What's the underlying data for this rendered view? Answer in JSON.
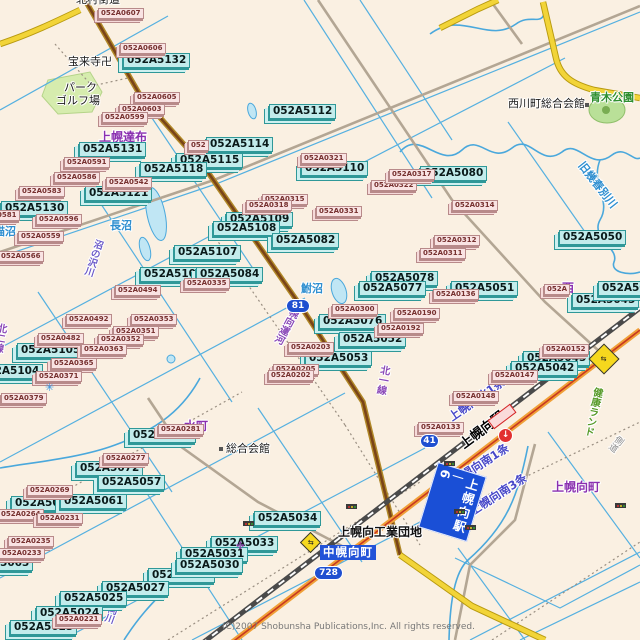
{
  "map": {
    "copyright": "(C)2007 Shobunsha Publications,Inc. All rights reserved.",
    "colors": {
      "background": "#faf0e2",
      "water": "#55b0e0",
      "lake_fill": "#c0e6f4",
      "cyan_label_bg": "#c2ecec",
      "pink_label_bg": "#f9e3e3",
      "national_road": "#f0a038",
      "pref_road_yellow": "#f2d438",
      "road_81_brown": "#7a4418",
      "railway": "#4a4a4a",
      "district_purple": "#8a2fb0",
      "badge_blue": "#1f4fd0",
      "banner_blue": "#2353d8",
      "park_green": "#d6ecae"
    },
    "station_banner": {
      "text": "上幌向駅",
      "number": "6"
    },
    "town_banner": {
      "text": "中幌向町"
    },
    "route_badges": [
      {
        "text": "81",
        "x": 286,
        "y": 299,
        "w": 22
      },
      {
        "text": "728",
        "x": 314,
        "y": 566,
        "w": 27
      },
      {
        "text": "41",
        "x": 420,
        "y": 434,
        "w": 17
      }
    ],
    "area_labels": [
      {
        "text": "北村街道",
        "x": 76,
        "y": -6,
        "kind": "black"
      },
      {
        "text": "宝来寺卍",
        "x": 68,
        "y": 56,
        "kind": "black"
      },
      {
        "text": "パーク",
        "x": 64,
        "y": 82,
        "kind": "black"
      },
      {
        "text": "ゴルフ場",
        "x": 56,
        "y": 95,
        "kind": "black"
      },
      {
        "text": "西川町総合会館",
        "x": 508,
        "y": 98,
        "kind": "black"
      },
      {
        "text": "総合会館",
        "x": 226,
        "y": 443,
        "kind": "black"
      },
      {
        "text": "上幌向工業団地",
        "x": 338,
        "y": 526,
        "kind": "blackbold"
      },
      {
        "text": "青木公園",
        "x": 590,
        "y": 92,
        "kind": "green"
      },
      {
        "text": "上幌達布",
        "x": 99,
        "y": 131,
        "kind": "purple"
      },
      {
        "text": "水町",
        "x": 184,
        "y": 420,
        "kind": "purple"
      },
      {
        "text": "上幌向町",
        "x": 552,
        "y": 481,
        "kind": "purple"
      },
      {
        "text": "西",
        "x": 562,
        "y": 282,
        "kind": "purple"
      },
      {
        "text": "長沼",
        "x": 110,
        "y": 220,
        "kind": "blue"
      },
      {
        "text": "鮒沼",
        "x": 301,
        "y": 283,
        "kind": "blue"
      },
      {
        "text": "猫沼",
        "x": -6,
        "y": 226,
        "kind": "blue"
      },
      {
        "text": "旧幾春別川",
        "x": 585,
        "y": 160,
        "kind": "blue",
        "rot": 52
      },
      {
        "text": "上幌向駅",
        "x": 458,
        "y": 441,
        "kind": "stationblack",
        "rot": -37
      },
      {
        "text": "上幌向北1条",
        "x": 447,
        "y": 414,
        "kind": "bluestreet",
        "rot": -35
      },
      {
        "text": "上幌向南1条",
        "x": 450,
        "y": 478,
        "kind": "bluestreet",
        "rot": -33
      },
      {
        "text": "上幌向南3条",
        "x": 468,
        "y": 508,
        "kind": "bluestreet",
        "rot": -33
      },
      {
        "text": "幌向運河",
        "x": 290,
        "y": 305,
        "kind": "rural",
        "vert": true,
        "rot": 28
      },
      {
        "text": "北一線",
        "x": 379,
        "y": 364,
        "kind": "rural",
        "vert": true,
        "rot": 10
      },
      {
        "text": "北二線",
        "x": -4,
        "y": 322,
        "kind": "rural",
        "vert": true,
        "rot": 10
      },
      {
        "text": "沼の沢川",
        "x": 94,
        "y": 238,
        "kind": "stream",
        "vert": true,
        "rot": 18
      },
      {
        "text": "幌向川",
        "x": 112,
        "y": 594,
        "kind": "stream",
        "vert": true,
        "rot": 20
      },
      {
        "text": "健康ランド",
        "x": 592,
        "y": 386,
        "kind": "greenvert",
        "vert": true,
        "rot": 12
      },
      {
        "text": "側道",
        "x": 617,
        "y": 433,
        "kind": "gray",
        "vert": true,
        "rot": 38
      }
    ],
    "parcel_labels_cyan": [
      {
        "text": "052A5132",
        "x": 123,
        "y": 53
      },
      {
        "text": "052A5112",
        "x": 269,
        "y": 104
      },
      {
        "text": "052A5114",
        "x": 206,
        "y": 137
      },
      {
        "text": "052A5131",
        "x": 79,
        "y": 142
      },
      {
        "text": "052A5115",
        "x": 176,
        "y": 153
      },
      {
        "text": "052A5118",
        "x": 140,
        "y": 162
      },
      {
        "text": "052A5121",
        "x": 85,
        "y": 186
      },
      {
        "text": "052A5130",
        "x": 1,
        "y": 201
      },
      {
        "text": "052A5110",
        "x": 301,
        "y": 161
      },
      {
        "text": "052A5109",
        "x": 226,
        "y": 212
      },
      {
        "text": "052A5108",
        "x": 213,
        "y": 221
      },
      {
        "text": "052A5082",
        "x": 272,
        "y": 233
      },
      {
        "text": "052A5080",
        "x": 420,
        "y": 166
      },
      {
        "text": "052A5107",
        "x": 174,
        "y": 245
      },
      {
        "text": "052A5106",
        "x": 140,
        "y": 267
      },
      {
        "text": "052A5084",
        "x": 196,
        "y": 267
      },
      {
        "text": "052A5105",
        "x": 17,
        "y": 343
      },
      {
        "text": "052A5104",
        "x": -24,
        "y": 364
      },
      {
        "text": "052A5078",
        "x": 371,
        "y": 271
      },
      {
        "text": "052A5077",
        "x": 359,
        "y": 281
      },
      {
        "text": "052A5076",
        "x": 319,
        "y": 314
      },
      {
        "text": "052A5052",
        "x": 339,
        "y": 332
      },
      {
        "text": "052A5053",
        "x": 305,
        "y": 351
      },
      {
        "text": "052A5051",
        "x": 451,
        "y": 281
      },
      {
        "text": "052A5050",
        "x": 559,
        "y": 230
      },
      {
        "text": "052A5045",
        "x": 572,
        "y": 293
      },
      {
        "text": "052A5046",
        "x": 598,
        "y": 281
      },
      {
        "text": "052A5043",
        "x": 523,
        "y": 351
      },
      {
        "text": "052A5042",
        "x": 511,
        "y": 361
      },
      {
        "text": "052A5074",
        "x": 129,
        "y": 428
      },
      {
        "text": "052A5072",
        "x": 76,
        "y": 461
      },
      {
        "text": "052A5057",
        "x": 98,
        "y": 475
      },
      {
        "text": "052A5069",
        "x": 11,
        "y": 496
      },
      {
        "text": "052A5061",
        "x": 60,
        "y": 494
      },
      {
        "text": "052A5063",
        "x": -34,
        "y": 556
      },
      {
        "text": "052A5028",
        "x": 148,
        "y": 568
      },
      {
        "text": "052A5027",
        "x": 102,
        "y": 581
      },
      {
        "text": "052A5025",
        "x": 60,
        "y": 591
      },
      {
        "text": "052A5024",
        "x": 36,
        "y": 606
      },
      {
        "text": "052A5023",
        "x": 10,
        "y": 620
      },
      {
        "text": "052A5034",
        "x": 254,
        "y": 511
      },
      {
        "text": "052A5033",
        "x": 211,
        "y": 536
      },
      {
        "text": "052A5031",
        "x": 181,
        "y": 547
      },
      {
        "text": "052A5030",
        "x": 176,
        "y": 558
      }
    ],
    "parcel_labels_pink": [
      {
        "text": "052A0607",
        "x": 98,
        "y": 8
      },
      {
        "text": "052A0606",
        "x": 120,
        "y": 43
      },
      {
        "text": "052A0605",
        "x": 134,
        "y": 92
      },
      {
        "text": "052A0603",
        "x": 119,
        "y": 104
      },
      {
        "text": "052A0599",
        "x": 102,
        "y": 112
      },
      {
        "text": "052A0591",
        "x": 64,
        "y": 157
      },
      {
        "text": "052A0586",
        "x": 54,
        "y": 172
      },
      {
        "text": "052A0583",
        "x": 19,
        "y": 186
      },
      {
        "text": "052A0581",
        "x": -26,
        "y": 210
      },
      {
        "text": "052A0596",
        "x": 36,
        "y": 214
      },
      {
        "text": "052A0559",
        "x": 18,
        "y": 231
      },
      {
        "text": "052A0566",
        "x": -2,
        "y": 251
      },
      {
        "text": "052A0542",
        "x": 106,
        "y": 177
      },
      {
        "text": "052A0321",
        "x": 301,
        "y": 153
      },
      {
        "text": "052A0322",
        "x": 371,
        "y": 180
      },
      {
        "text": "052A0317",
        "x": 389,
        "y": 169
      },
      {
        "text": "052A0315",
        "x": 262,
        "y": 194
      },
      {
        "text": "052A0318",
        "x": 246,
        "y": 200
      },
      {
        "text": "052A0331",
        "x": 316,
        "y": 206
      },
      {
        "text": "052A0314",
        "x": 452,
        "y": 200
      },
      {
        "text": "052A0312",
        "x": 434,
        "y": 235
      },
      {
        "text": "052A0311",
        "x": 420,
        "y": 248
      },
      {
        "text": "052A0335",
        "x": 184,
        "y": 278
      },
      {
        "text": "052A0494",
        "x": 115,
        "y": 285
      },
      {
        "text": "052A0492",
        "x": 66,
        "y": 314
      },
      {
        "text": "052A0482",
        "x": 38,
        "y": 333
      },
      {
        "text": "052A0353",
        "x": 131,
        "y": 314
      },
      {
        "text": "052A0351",
        "x": 113,
        "y": 326
      },
      {
        "text": "052A0352",
        "x": 98,
        "y": 334
      },
      {
        "text": "052A0363",
        "x": 81,
        "y": 344
      },
      {
        "text": "052A0365",
        "x": 51,
        "y": 358
      },
      {
        "text": "052A0371",
        "x": 36,
        "y": 371
      },
      {
        "text": "052A0379",
        "x": 1,
        "y": 393
      },
      {
        "text": "052A0300",
        "x": 332,
        "y": 304
      },
      {
        "text": "052A0190",
        "x": 394,
        "y": 308
      },
      {
        "text": "052A0192",
        "x": 378,
        "y": 323
      },
      {
        "text": "052A0203",
        "x": 288,
        "y": 342
      },
      {
        "text": "052A0205",
        "x": 273,
        "y": 364
      },
      {
        "text": "052A0202",
        "x": 268,
        "y": 370
      },
      {
        "text": "052A0136",
        "x": 433,
        "y": 289
      },
      {
        "text": "052A0152",
        "x": 543,
        "y": 344
      },
      {
        "text": "052A0147",
        "x": 492,
        "y": 370
      },
      {
        "text": "052A0148",
        "x": 453,
        "y": 391
      },
      {
        "text": "052A0133",
        "x": 418,
        "y": 422
      },
      {
        "text": "052A0281",
        "x": 158,
        "y": 424
      },
      {
        "text": "052A0277",
        "x": 103,
        "y": 453
      },
      {
        "text": "052A0269",
        "x": 27,
        "y": 485
      },
      {
        "text": "052A0264",
        "x": -2,
        "y": 509
      },
      {
        "text": "052A0231",
        "x": 37,
        "y": 513
      },
      {
        "text": "052A0235",
        "x": 8,
        "y": 536
      },
      {
        "text": "052A0233",
        "x": -1,
        "y": 548
      },
      {
        "text": "052A0221",
        "x": 56,
        "y": 614
      },
      {
        "text": "052A",
        "x": 544,
        "y": 284
      },
      {
        "text": "052",
        "x": 188,
        "y": 140
      }
    ],
    "icons": [
      {
        "type": "signal",
        "x": 444,
        "y": 461
      },
      {
        "type": "signal",
        "x": 454,
        "y": 509
      },
      {
        "type": "signal",
        "x": 465,
        "y": 525
      },
      {
        "type": "signal",
        "x": 615,
        "y": 503
      },
      {
        "type": "signal",
        "x": 346,
        "y": 504
      },
      {
        "type": "signal",
        "x": 243,
        "y": 521
      },
      {
        "type": "crossing",
        "x": 593,
        "y": 348,
        "s": 20
      },
      {
        "type": "crossing",
        "x": 303,
        "y": 535,
        "s": 13
      },
      {
        "type": "uturn",
        "x": 498,
        "y": 428,
        "glyph": "↓"
      },
      {
        "type": "platform",
        "x": 488,
        "y": 411
      },
      {
        "type": "floodgate",
        "x": 45,
        "y": 382,
        "glyph": "✳",
        "color": "#2e8fe0",
        "size": 11
      },
      {
        "type": "landmark",
        "x": 236,
        "y": 542,
        "glyph": "✤",
        "color": "#8040a0",
        "size": 10
      },
      {
        "type": "bdot",
        "x": 585,
        "y": 103
      },
      {
        "type": "bdot",
        "x": 219,
        "y": 447
      }
    ]
  }
}
